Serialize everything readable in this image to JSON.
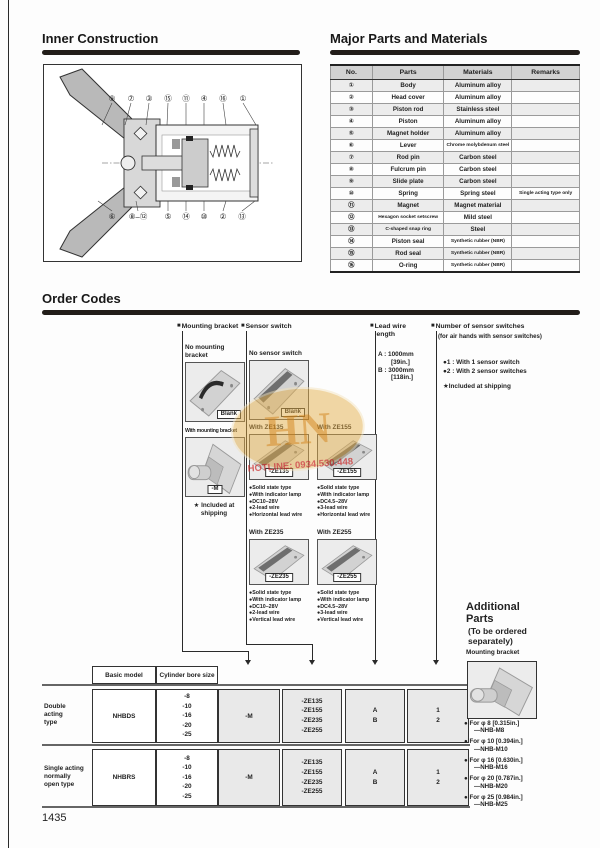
{
  "glyphs": {
    "square": "■",
    "dot": "●",
    "star": "★"
  },
  "page": {
    "number": "1435"
  },
  "watermark": {
    "letters": "HN",
    "hotline": "HOTLINE: 0934.530.448",
    "ellipse_color": "#e3ab45",
    "text_color": "#cc2a2a"
  },
  "inner_construction": {
    "title": "Inner Construction",
    "callouts_top": [
      "⑨",
      "⑦",
      "③",
      "⑮",
      "⑪",
      "④",
      "⑯",
      "①"
    ],
    "callouts_bottom": [
      "⑥",
      "⑧–⑫",
      "⑤",
      "⑭",
      "⑩",
      "②",
      "⑬"
    ]
  },
  "materials": {
    "title": "Major Parts and Materials",
    "headers": [
      "No.",
      "Parts",
      "Materials",
      "Remarks"
    ],
    "rows": [
      [
        "①",
        "Body",
        "Aluminum alloy",
        ""
      ],
      [
        "②",
        "Head cover",
        "Aluminum alloy",
        ""
      ],
      [
        "③",
        "Piston rod",
        "Stainless steel",
        ""
      ],
      [
        "④",
        "Piston",
        "Aluminum alloy",
        ""
      ],
      [
        "⑤",
        "Magnet holder",
        "Aluminum alloy",
        ""
      ],
      [
        "⑥",
        "Lever",
        "Chrome molybdenum steel",
        ""
      ],
      [
        "⑦",
        "Rod pin",
        "Carbon steel",
        ""
      ],
      [
        "⑧",
        "Fulcrum pin",
        "Carbon steel",
        ""
      ],
      [
        "⑨",
        "Slide plate",
        "Carbon steel",
        ""
      ],
      [
        "⑩",
        "Spring",
        "Spring steel",
        "Single acting type only"
      ],
      [
        "⑪",
        "Magnet",
        "Magnet material",
        ""
      ],
      [
        "⑫",
        "Hexagon socket setscrew",
        "Mild steel",
        ""
      ],
      [
        "⑬",
        "C-shaped snap ring",
        "Steel",
        ""
      ],
      [
        "⑭",
        "Piston seal",
        "Synthetic rubber (NBR)",
        ""
      ],
      [
        "⑮",
        "Rod seal",
        "Synthetic rubber (NBR)",
        ""
      ],
      [
        "⑯",
        "O-ring",
        "Synthetic rubber (NBR)",
        ""
      ]
    ]
  },
  "order_codes": {
    "title": "Order Codes",
    "mounting": {
      "header": "Mounting bracket",
      "no_label": "No mounting\nbracket",
      "no_code": "Blank",
      "with_label": "With mounting bracket",
      "with_code": "-M",
      "note": "★ Included at\nshipping"
    },
    "sensor": {
      "header": "Sensor switch",
      "no_label": "No sensor switch",
      "no_code": "Blank",
      "options": [
        {
          "label": "With ZE135",
          "code": "-ZE135",
          "features": [
            "Solid state type",
            "With indicator lamp",
            "DC10–28V",
            "2-lead wire",
            "Horizontal lead wire"
          ]
        },
        {
          "label": "With ZE155",
          "code": "-ZE155",
          "features": [
            "Solid state type",
            "With indicator lamp",
            "DC4.5–28V",
            "3-lead wire",
            "Horizontal lead wire"
          ]
        },
        {
          "label": "With ZE235",
          "code": "-ZE235",
          "features": [
            "Solid state type",
            "With indicator lamp",
            "DC10–28V",
            "2-lead wire",
            "Vertical lead wire"
          ]
        },
        {
          "label": "With ZE255",
          "code": "-ZE255",
          "features": [
            "Solid state type",
            "With indicator lamp",
            "DC4.5–28V",
            "3-lead wire",
            "Vertical lead wire"
          ]
        }
      ]
    },
    "lead_wire": {
      "header": "Lead wire\nlength",
      "lines": [
        "A : 1000mm",
        "[39in.]",
        "B : 3000mm",
        "[118in.]"
      ]
    },
    "count": {
      "header": "Number of sensor switches",
      "subheader": "(for air hands with sensor switches)",
      "options": [
        "1 : With 1 sensor switch",
        "2 : With 2 sensor switches"
      ],
      "note": "★Included at shipping"
    }
  },
  "model_table": {
    "headers": [
      "Basic model",
      "Cylinder bore size"
    ],
    "rows": [
      {
        "type": [
          "Double",
          "acting",
          "type"
        ],
        "model": "NHBDS",
        "bores": [
          "-8",
          "-10",
          "-16",
          "-20",
          "-25"
        ],
        "bracket": "-M",
        "switches": [
          "-ZE135",
          "-ZE155",
          "-ZE235",
          "-ZE255"
        ],
        "lead": [
          "A",
          "B"
        ],
        "count": [
          "1",
          "2"
        ]
      },
      {
        "type": [
          "Single acting",
          "normally",
          "open type"
        ],
        "model": "NHBRS",
        "bores": [
          "-8",
          "-10",
          "-16",
          "-20",
          "-25"
        ],
        "bracket": "-M",
        "switches": [
          "-ZE135",
          "-ZE155",
          "-ZE235",
          "-ZE255"
        ],
        "lead": [
          "A",
          "B"
        ],
        "count": [
          "1",
          "2"
        ]
      }
    ]
  },
  "additional": {
    "title": "Additional\nParts",
    "subtitle": "(To be ordered\nseparately)",
    "item": "Mounting bracket",
    "options": [
      {
        "line1": "For φ 8 [0.315in.]",
        "line2": "—NHB-M8"
      },
      {
        "line1": "For φ 10 [0.394in.]",
        "line2": "—NHB-M10"
      },
      {
        "line1": "For φ 16 [0.630in.]",
        "line2": "—NHB-M16"
      },
      {
        "line1": "For φ 20 [0.787in.]",
        "line2": "—NHB-M20"
      },
      {
        "line1": "For φ 25 [0.984in.]",
        "line2": "—NHB-M25"
      }
    ]
  }
}
